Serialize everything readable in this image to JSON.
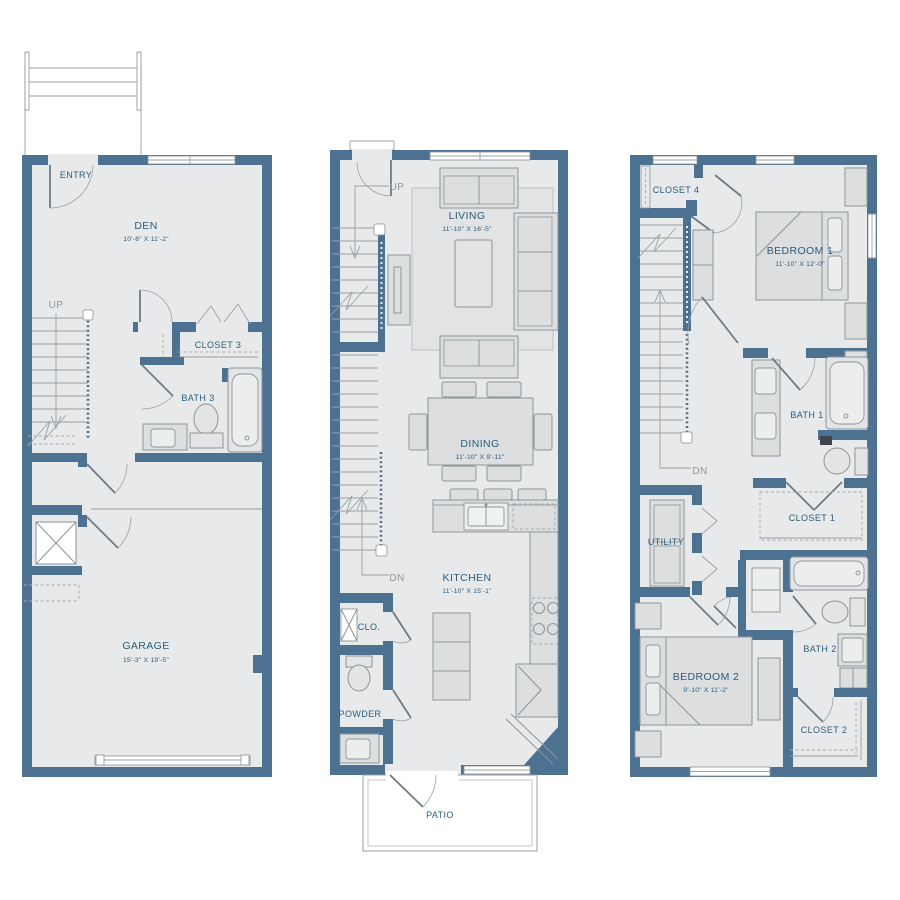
{
  "title": "3-story townhome floor plan",
  "colors": {
    "wall": "#4d7191",
    "floor": "#e8e9ea",
    "label_text": "#2b5d7d",
    "muted_text": "#8f979c",
    "furniture": "#dcdedf"
  },
  "floor1": {
    "entry": "ENTRY",
    "den": "DEN",
    "den_dims": "10'-6\" X 11'-2\"",
    "up": "UP",
    "closet3": "CLOSET 3",
    "bath3": "BATH 3",
    "garage": "GARAGE",
    "garage_dims": "15'-3\" X 19'-5\""
  },
  "floor2": {
    "up": "UP",
    "dn": "DN",
    "living": "LIVING",
    "living_dims": "11'-10\" X 16'-5\"",
    "dining": "DINING",
    "dining_dims": "11'-10\" X 9'-11\"",
    "kitchen": "KITCHEN",
    "kitchen_dims": "11'-10\" X 15'-1\"",
    "clo": "CLO.",
    "powder": "POWDER",
    "patio": "PATIO"
  },
  "floor3": {
    "closet4": "CLOSET 4",
    "bedroom1": "BEDROOM 1",
    "bedroom1_dims": "11'-10\" X 12'-0\"",
    "dn": "DN",
    "bath1": "BATH 1",
    "closet1": "CLOSET 1",
    "utility": "UTILITY",
    "bedroom2": "BEDROOM 2",
    "bedroom2_dims": "9'-10\" X 11'-2\"",
    "bath2": "BATH 2",
    "closet2": "CLOSET 2"
  }
}
